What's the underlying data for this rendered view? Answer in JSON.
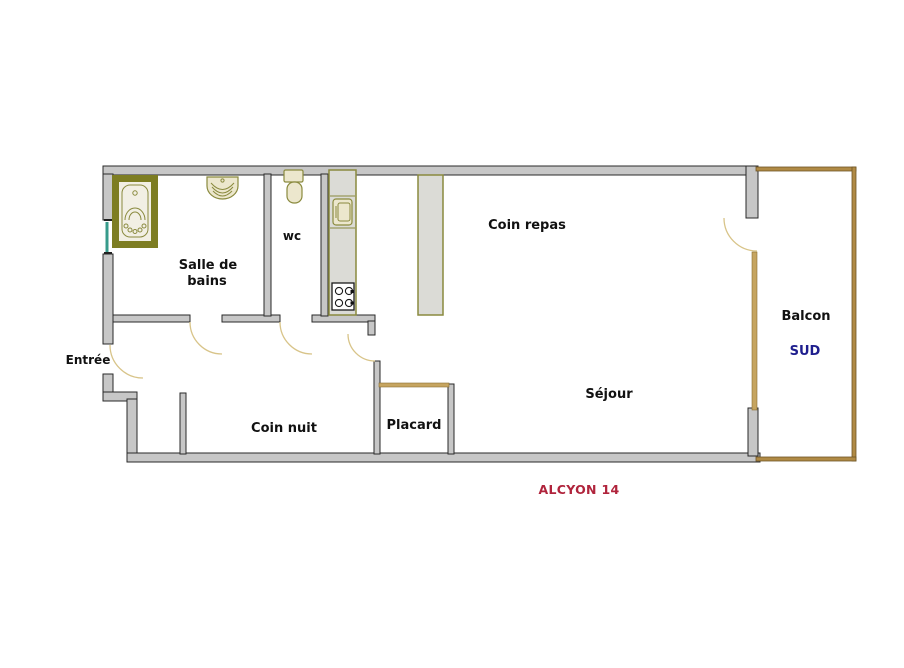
{
  "title": "ALCYON 14",
  "colors": {
    "wall_fill": "#c7c7c7",
    "wall_edge": "#2a2a2a",
    "balcony_tan": "#b08a45",
    "window_tan": "#c6a560",
    "fixture_olive": "#7d7d22",
    "fixture_outline": "#8a8a3e",
    "fixture_fill": "#ece7cd",
    "kitchen_fill": "#dbdbd6",
    "door_arc": "#d8c489",
    "window_teal": "#379b8b",
    "label_black": "#111111",
    "sud_blue": "#1e1e8e",
    "title_red": "#b0243c"
  },
  "rooms": {
    "salle_de_bains": {
      "label_line1": "Salle de",
      "label_line2": "bains"
    },
    "wc": {
      "label": "wc"
    },
    "coin_repas": {
      "label": "Coin repas"
    },
    "entree": {
      "label": "Entrée"
    },
    "coin_nuit": {
      "label": "Coin nuit"
    },
    "placard": {
      "label": "Placard"
    },
    "sejour": {
      "label": "Séjour"
    },
    "balcon": {
      "label": "Balcon",
      "orientation": "SUD"
    }
  },
  "fixtures": [
    "bathtub",
    "washbasin",
    "toilet",
    "kitchen-counter",
    "kitchen-sink",
    "stove",
    "dining-partition",
    "window-west",
    "window-south"
  ]
}
